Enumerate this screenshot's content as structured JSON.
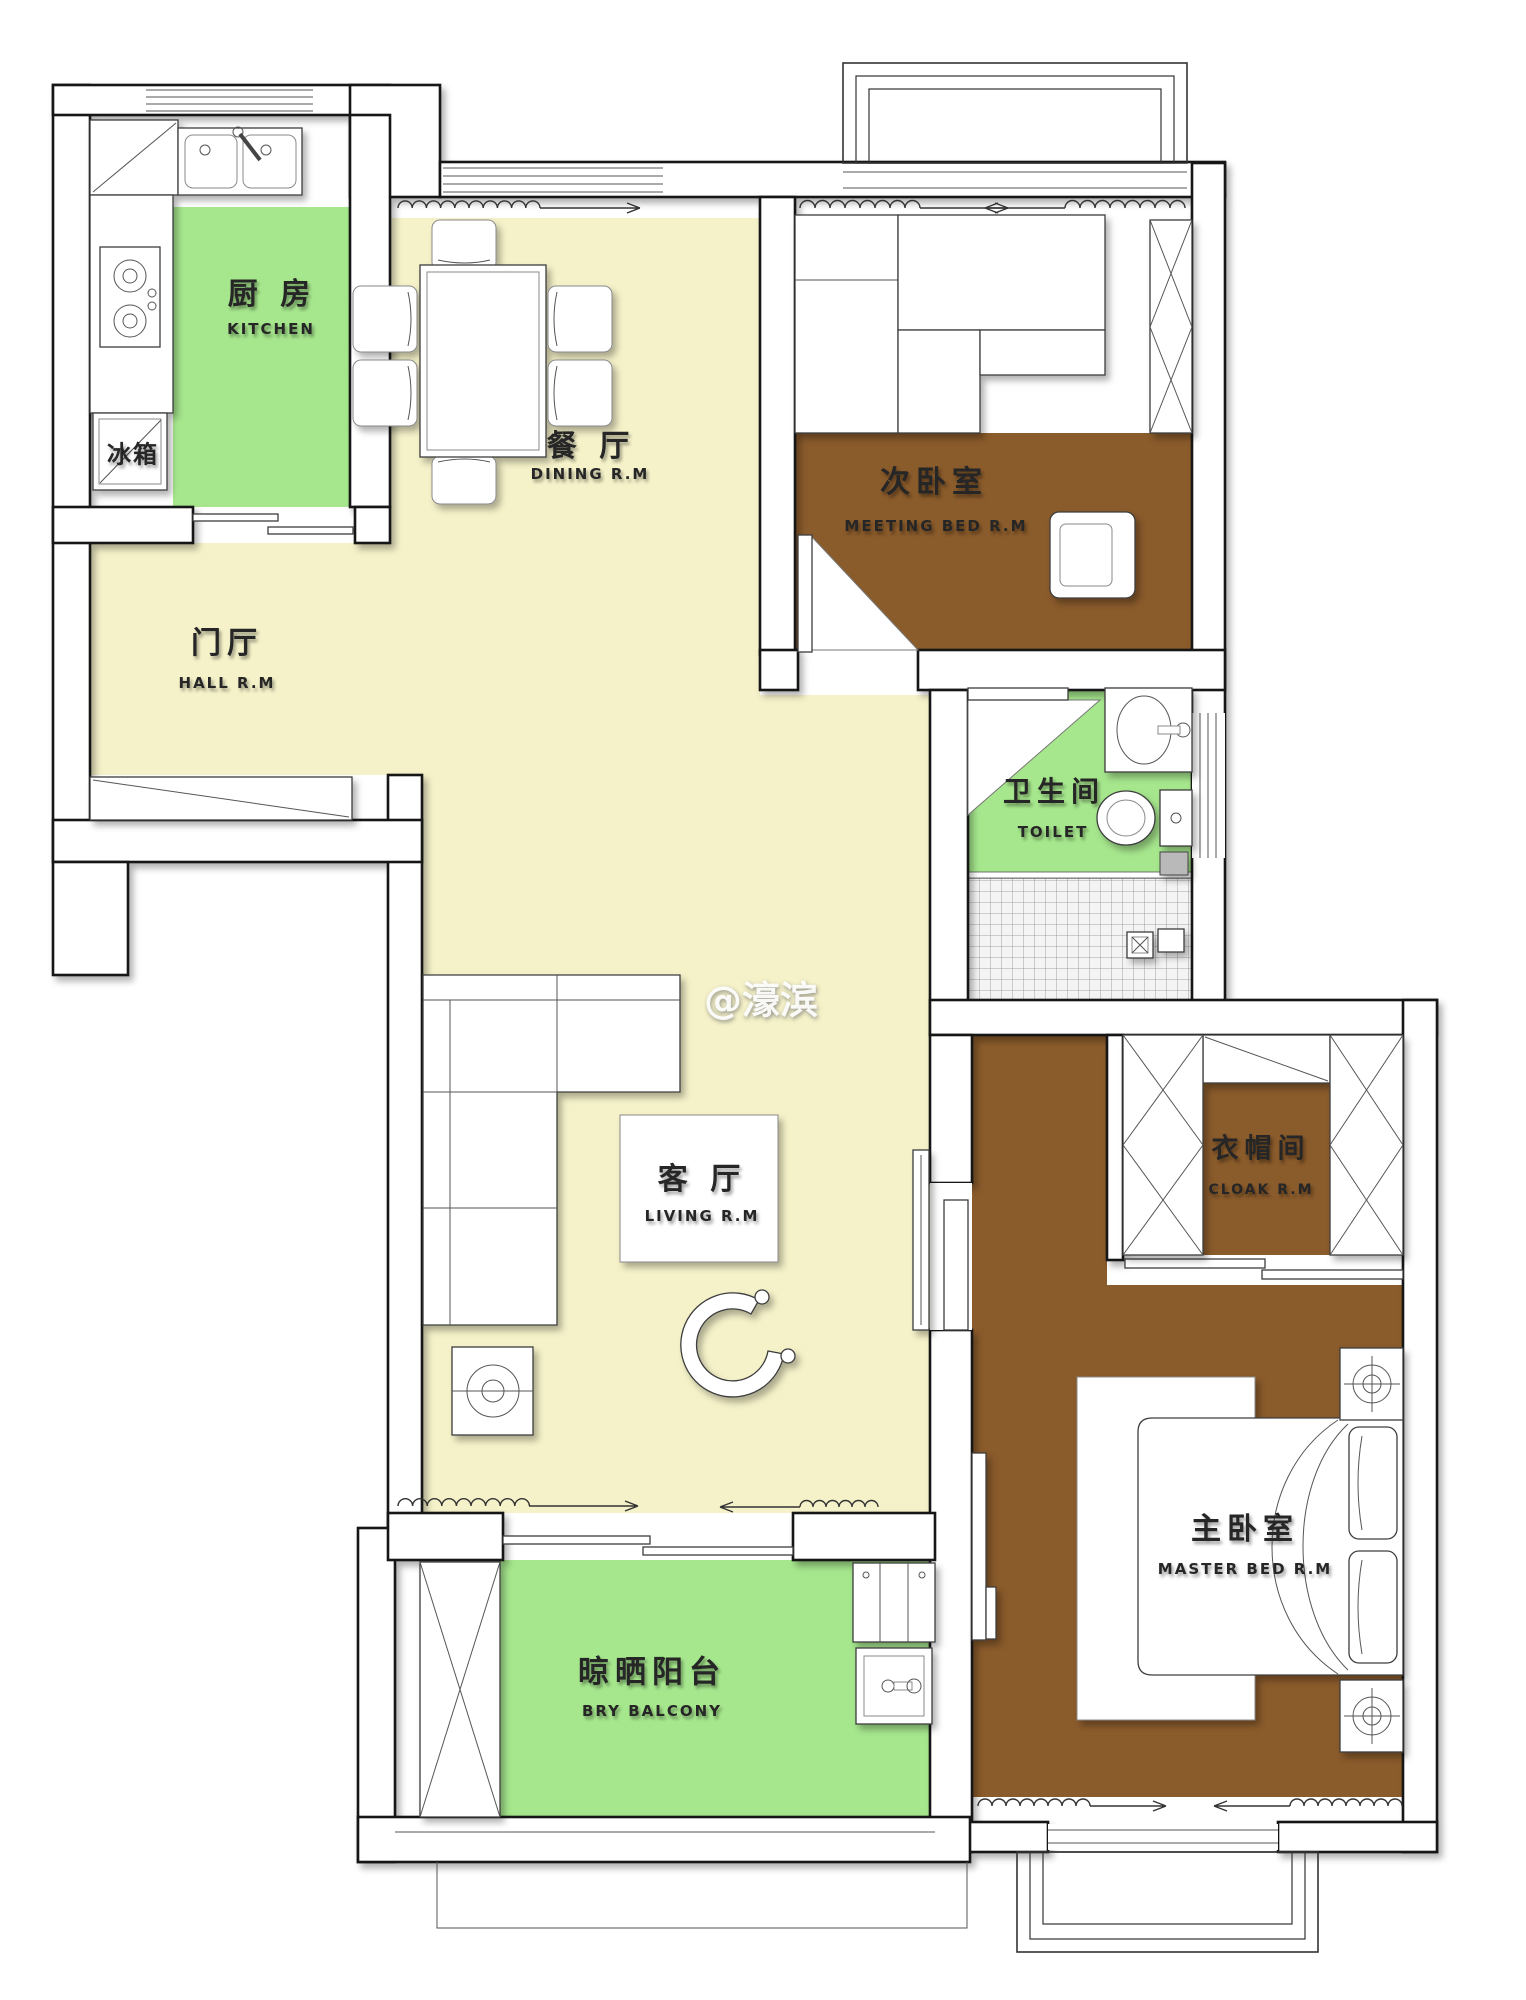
{
  "watermark": "@濠滨",
  "colors": {
    "floor_green": "#a6e78d",
    "floor_cream": "#f5f2c9",
    "floor_brown": "#8a5b2b",
    "wall_fill": "#ffffff",
    "line": "#141414"
  },
  "rooms": {
    "kitchen": {
      "cn": "厨 房",
      "en": "KITCHEN"
    },
    "dining": {
      "cn": "餐 厅",
      "en": "DINING R.M"
    },
    "hall": {
      "cn": "门厅",
      "en": "HALL R.M"
    },
    "secondary_bedroom": {
      "cn": "次卧室",
      "en": "MEETING BED R.M"
    },
    "toilet": {
      "cn": "卫生间",
      "en": "TOILET"
    },
    "living": {
      "cn": "客 厅",
      "en": "LIVING R.M"
    },
    "cloak": {
      "cn": "衣帽间",
      "en": "CLOAK R.M"
    },
    "master_bedroom": {
      "cn": "主卧室",
      "en": "MASTER BED R.M"
    },
    "balcony": {
      "cn": "晾晒阳台",
      "en": "BRY BALCONY"
    }
  },
  "appliances": {
    "fridge": "冰箱"
  }
}
